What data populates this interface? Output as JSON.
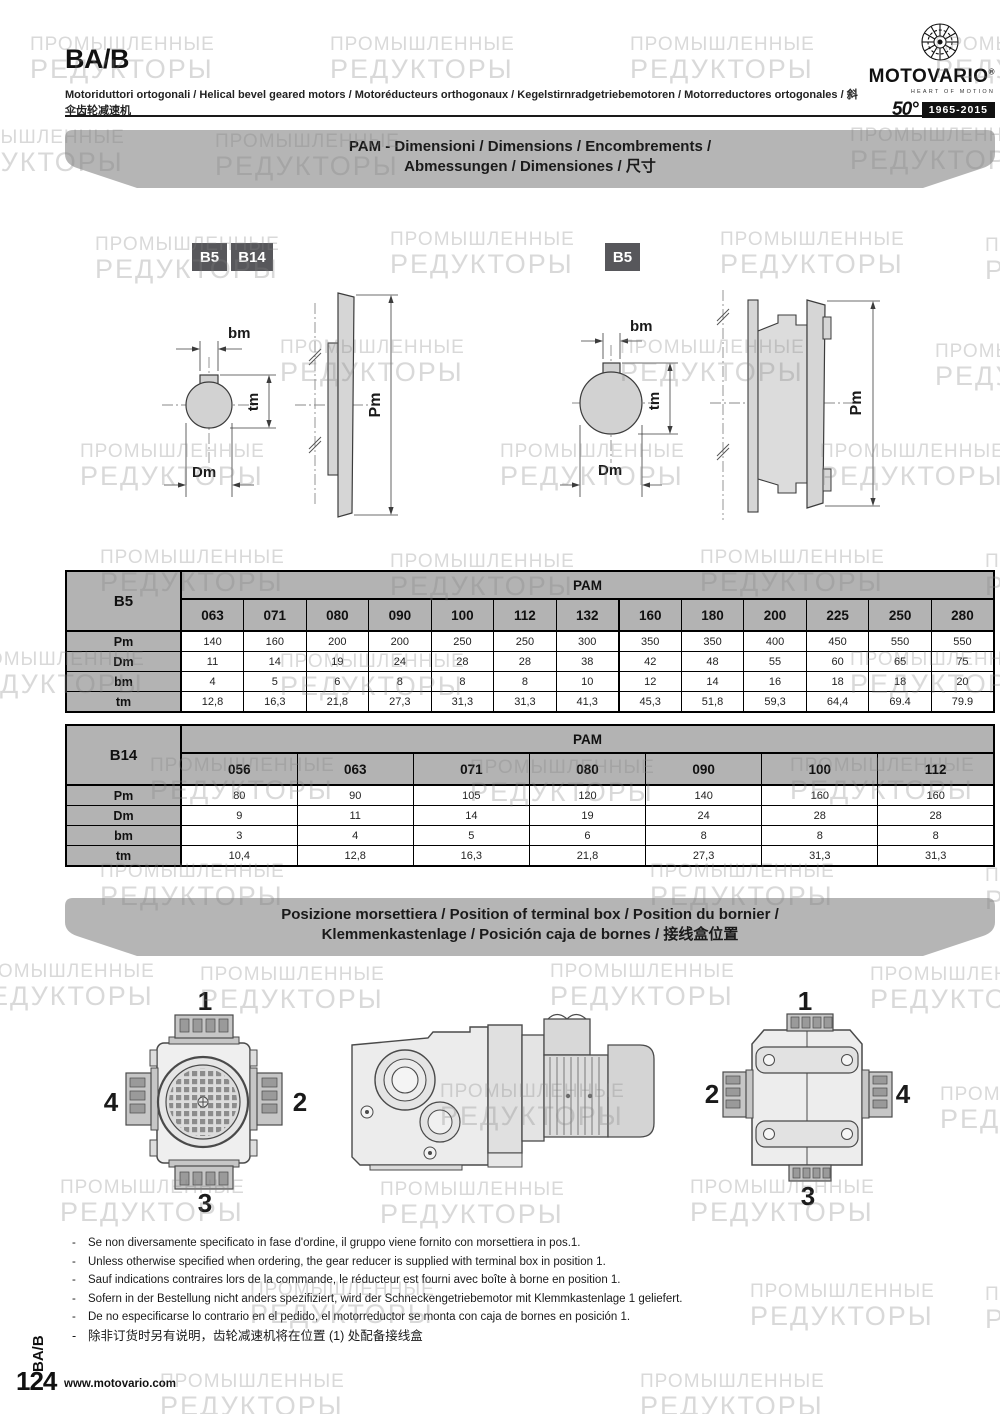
{
  "header": {
    "code": "BA/B",
    "subtitle": "Motoriduttori ortogonali / Helical bevel geared motors / Motoréducteurs orthogonaux / Kegelstirnradgetriebemotoren / Motorreductores ortogonales / 斜伞齿轮减速机"
  },
  "brand": {
    "name": "MOTOVARIO",
    "reg_mark": "®",
    "tagline": "HEART OF MOTION",
    "anniversary_number": "50°",
    "anniversary_years": "1965-2015"
  },
  "watermark": {
    "line1": "ПРОМЫШЛЕННЫЕ",
    "line2": "РЕДУКТОРЫ"
  },
  "pam_banner": {
    "line1": "PAM - Dimensioni / Dimensions / Encombrements /",
    "line2": "Abmessungen / Dimensiones / 尺寸"
  },
  "terminal_banner": {
    "line1": "Posizione morsettiera / Position of terminal box / Position du bornier /",
    "line2": "Klemmenkastenlage / Posición caja de bornes / 接线盒位置"
  },
  "diagrams": {
    "left_tags": [
      "B5",
      "B14"
    ],
    "right_tag": "B5",
    "labels": {
      "bm": "bm",
      "tm": "tm",
      "dm": "Dm",
      "pm": "Pm"
    }
  },
  "tables": {
    "b5": {
      "row_header": "B5",
      "group_header": "PAM",
      "columns": [
        "063",
        "071",
        "080",
        "090",
        "100",
        "112",
        "132",
        "160",
        "180",
        "200",
        "225",
        "250",
        "280"
      ],
      "rows": [
        {
          "label": "Pm",
          "values": [
            "140",
            "160",
            "200",
            "200",
            "250",
            "250",
            "300",
            "350",
            "350",
            "400",
            "450",
            "550",
            "550"
          ]
        },
        {
          "label": "Dm",
          "values": [
            "11",
            "14",
            "19",
            "24",
            "28",
            "28",
            "38",
            "42",
            "48",
            "55",
            "60",
            "65",
            "75"
          ]
        },
        {
          "label": "bm",
          "values": [
            "4",
            "5",
            "6",
            "8",
            "8",
            "8",
            "10",
            "12",
            "14",
            "16",
            "18",
            "18",
            "20"
          ]
        },
        {
          "label": "tm",
          "values": [
            "12,8",
            "16,3",
            "21,8",
            "27,3",
            "31,3",
            "31,3",
            "41,3",
            "45,3",
            "51,8",
            "59,3",
            "64,4",
            "69.4",
            "79.9"
          ]
        }
      ]
    },
    "b14": {
      "row_header": "B14",
      "group_header": "PAM",
      "columns": [
        "056",
        "063",
        "071",
        "080",
        "090",
        "100",
        "112"
      ],
      "rows": [
        {
          "label": "Pm",
          "values": [
            "80",
            "90",
            "105",
            "120",
            "140",
            "160",
            "160"
          ]
        },
        {
          "label": "Dm",
          "values": [
            "9",
            "11",
            "14",
            "19",
            "24",
            "28",
            "28"
          ]
        },
        {
          "label": "bm",
          "values": [
            "3",
            "4",
            "5",
            "6",
            "8",
            "8",
            "8"
          ]
        },
        {
          "label": "tm",
          "values": [
            "10,4",
            "12,8",
            "16,3",
            "21,8",
            "27,3",
            "31,3",
            "31,3"
          ]
        }
      ]
    }
  },
  "positions": {
    "rear": {
      "top": "1",
      "right": "2",
      "bottom": "3",
      "left": "4"
    },
    "front": {
      "top": "1",
      "left": "2",
      "right": "4",
      "bottom": "3"
    }
  },
  "notes": [
    "Se non diversamente specificato in fase d'ordine, il gruppo viene fornito con morsettiera in pos.1.",
    "Unless otherwise specified when ordering, the gear reducer is supplied with terminal box in position 1.",
    "Sauf indications contraires lors de la commande, le réducteur est fourni avec boîte à borne en position 1.",
    "Sofern in der Bestellung nicht anders spezifiziert, wird der Schneckengetriebemotor mit Klemmkastenlage 1 geliefert.",
    "De no especificarse lo contrario en el pedido, el motorreductor se monta con caja de bornes en posición 1.",
    "除非订货时另有说明，齿轮减速机将在位置 (1) 处配备接线盒"
  ],
  "footer": {
    "side_label": "BA/B",
    "page_number": "124",
    "website": "www.motovario.com"
  }
}
